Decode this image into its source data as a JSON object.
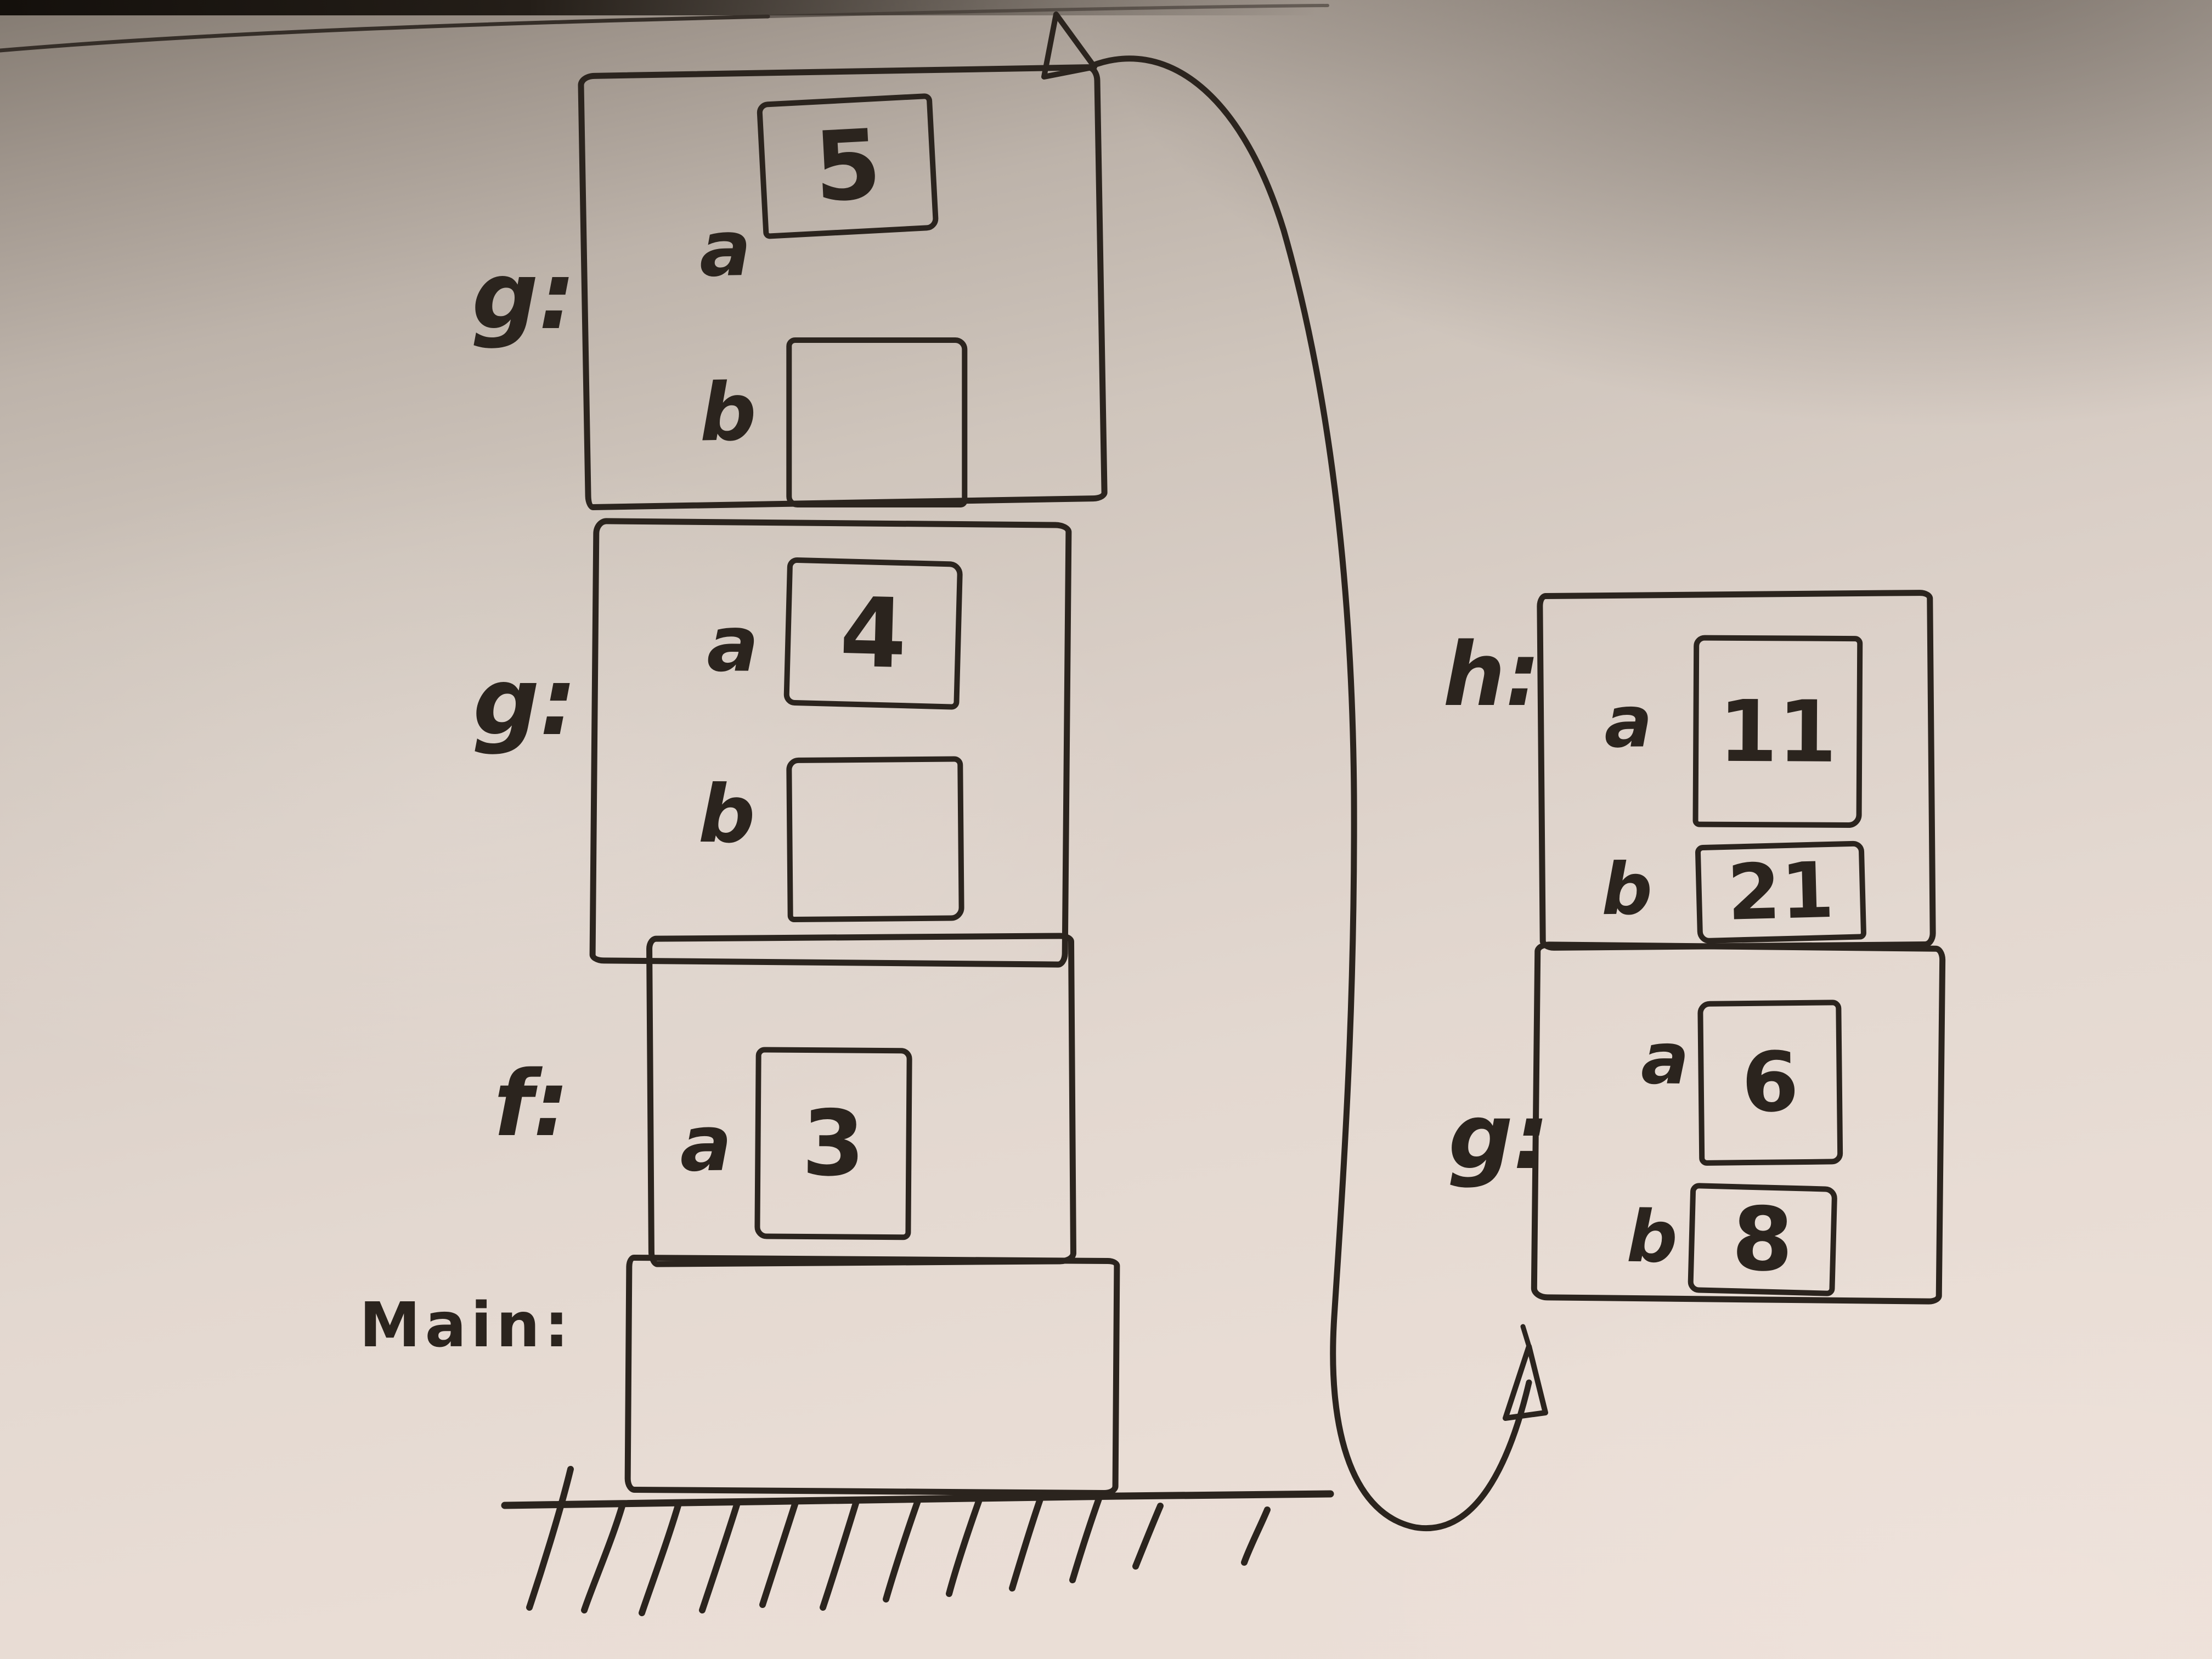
{
  "board": {
    "description": "Whiteboard photo: hand-drawn call-stack diagram",
    "ink_color": "#2b241e",
    "surface_top_color": "#837a71",
    "surface_bottom_color": "#ecdfd8"
  },
  "stack": {
    "frames": [
      {
        "label": "g:",
        "vars": [
          {
            "name": "a",
            "value": "5"
          },
          {
            "name": "b",
            "value": ""
          }
        ]
      },
      {
        "label": "g:",
        "vars": [
          {
            "name": "a",
            "value": "4"
          },
          {
            "name": "b",
            "value": ""
          }
        ]
      },
      {
        "label": "f:",
        "vars": [
          {
            "name": "a",
            "value": "3"
          }
        ]
      },
      {
        "label": "Main:",
        "vars": []
      }
    ]
  },
  "side_frames": [
    {
      "label": "h:",
      "vars": [
        {
          "name": "a",
          "value": "11"
        },
        {
          "name": "b",
          "value": "21"
        }
      ]
    },
    {
      "label": "g:",
      "vars": [
        {
          "name": "a",
          "value": "6"
        },
        {
          "name": "b",
          "value": "8"
        }
      ]
    }
  ],
  "arrow": {
    "type": "curved-double-headed-arrow",
    "from": "top of left stack",
    "to": "below right-hand frames"
  },
  "ground": {
    "hatch_count": 12
  }
}
